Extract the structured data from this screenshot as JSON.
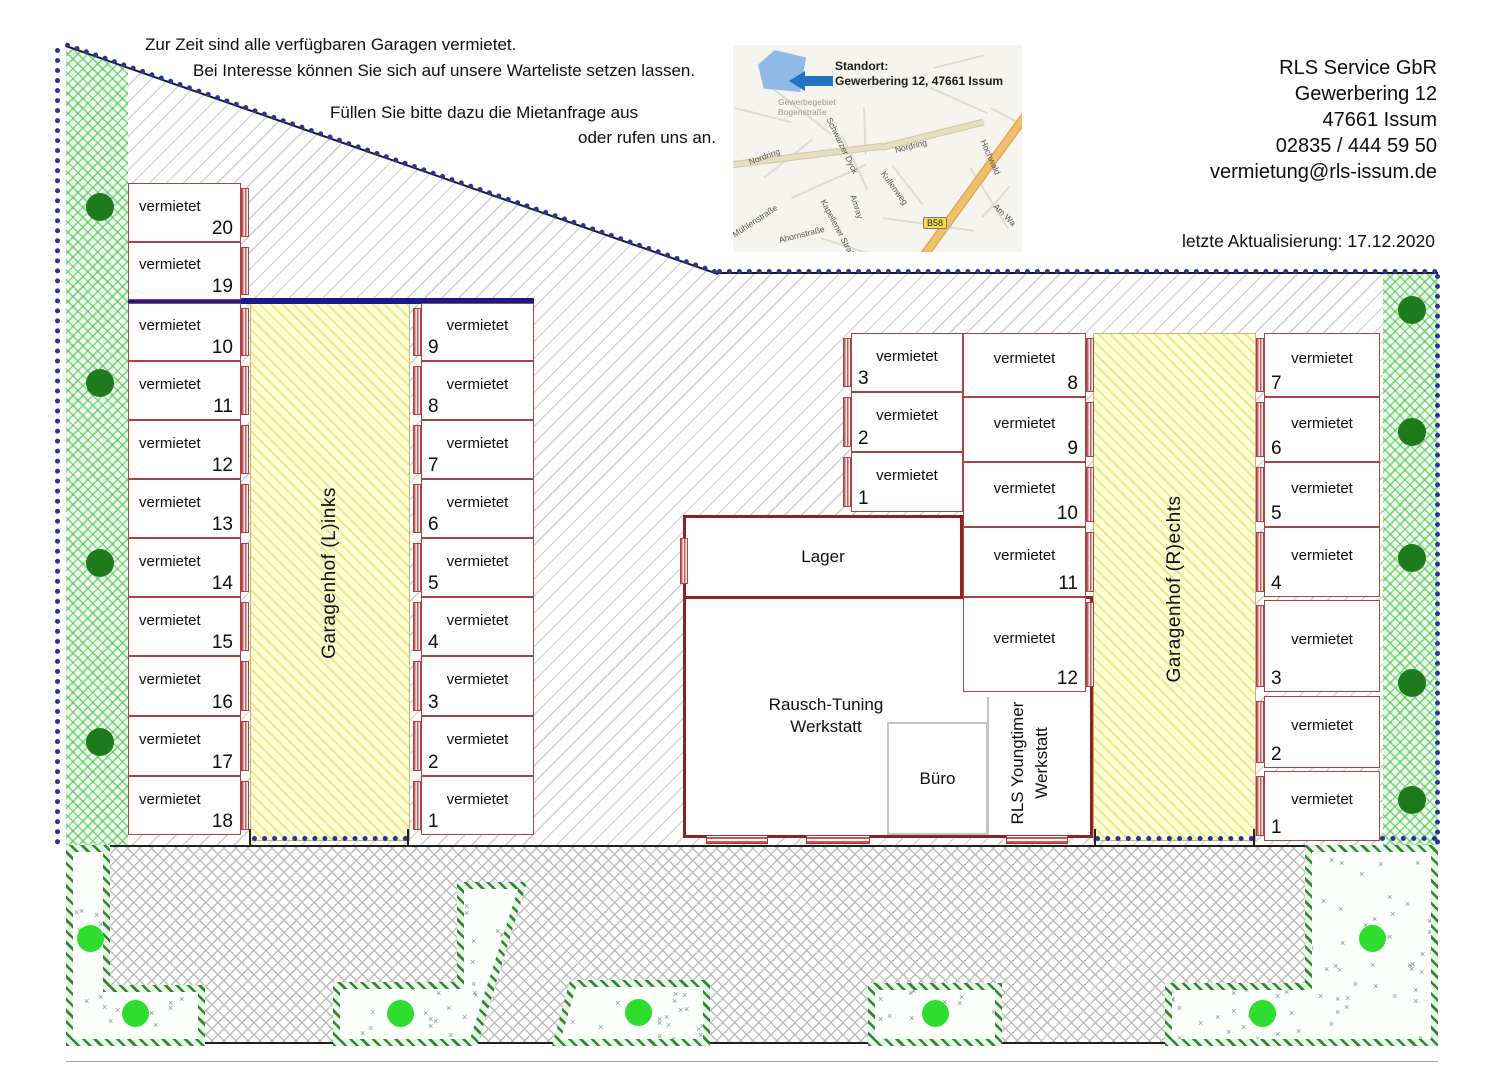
{
  "notice": {
    "line1": "Zur Zeit sind alle verfügbaren Garagen vermietet.",
    "line2": "Bei Interesse können Sie sich auf unsere Warteliste setzen lassen.",
    "line3": "Füllen Sie bitte dazu die Mietanfrage aus",
    "line4": "oder rufen uns an."
  },
  "company": {
    "name": "RLS Service GbR",
    "street": "Gewerbering 12",
    "city": "47661 Issum",
    "phone": "02835 / 444 59 50",
    "email": "vermietung@rls-issum.de"
  },
  "updated": "letzte Aktualisierung: 17.12.2020",
  "map": {
    "standort_title": "Standort:",
    "standort_address": "Gewerbering 12, 47661 Issum",
    "b58": "B58",
    "streets": [
      "Gewerbegebiet",
      "Bogenstraße",
      "Nordring",
      "Nordring",
      "Schwarzer Dyck",
      "Kullenweg",
      "Amray",
      "Kapellener Straße",
      "Mühlenstraße",
      "Ahornstraße",
      "Hochwald",
      "Am Wa"
    ]
  },
  "garages": {
    "status_label": "vermietet",
    "left_outer": [
      20,
      19,
      10,
      11,
      12,
      13,
      14,
      15,
      16,
      17,
      18
    ],
    "left_inner": [
      9,
      8,
      7,
      6,
      5,
      4,
      3,
      2,
      1
    ],
    "middle_left": [
      3,
      2,
      1
    ],
    "middle_right": [
      8,
      9,
      10,
      11,
      12
    ],
    "right_inner": [
      7,
      6,
      5,
      4,
      3,
      2,
      1
    ]
  },
  "yards": {
    "left": "Garagenhof (L)inks",
    "right": "Garagenhof (R)echts"
  },
  "rooms": {
    "lager": "Lager",
    "werkstatt_line1": "Rausch-Tuning",
    "werkstatt_line2": "Werkstatt",
    "buero": "Büro",
    "youngtimer_line1": "RLS Youngtimer",
    "youngtimer_line2": "Werkstatt"
  },
  "colors": {
    "boundary_navy": "#24349c",
    "divider_navy": "#1a1a8f",
    "garage_wall": "#a84444",
    "building_wall": "#8b2525",
    "yard_yellow": "#ffffd6",
    "green_area": "#f0fcf0",
    "tree_dark": "#1d7a1d",
    "tree_bright": "#2ede2e",
    "arrow_blue": "#1f74c4"
  }
}
